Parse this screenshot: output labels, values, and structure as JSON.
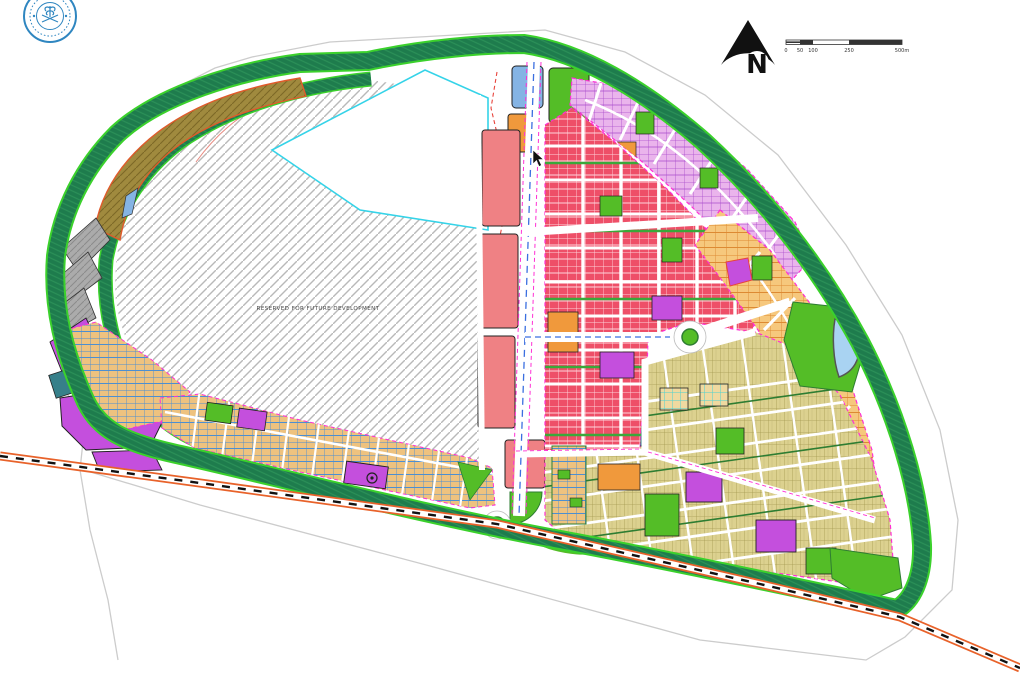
{
  "annotations": {
    "reserved_label": "RESERVED FOR FUTURE DEVELOPMENT"
  },
  "compass": {
    "label": "N"
  },
  "scale_bar": {
    "ticks": [
      "0",
      "50",
      "100",
      "250",
      "500m"
    ]
  },
  "palette": {
    "green_belt": "#1e7c4d",
    "green_belt_edge": "#3bd12c",
    "park_green": "#54bd27",
    "residential_red": "#ee4f68",
    "residential_pink": "#eab4ec",
    "residential_orange_lots": "#f6c87d",
    "residential_khaki": "#dcd18f",
    "lots_blue_hatch": "#4d8fd1",
    "commercial_salmon": "#ef8184",
    "facility_purple": "#c44fdd",
    "facility_blue": "#85b4e4",
    "facility_orange": "#f0993c",
    "facility_teal": "#37808a",
    "agriculture_olive": "#a08a3e",
    "utility_gray": "#ababab",
    "water_blue": "#a9d3f2",
    "railway_orange": "#e8622a",
    "road_edge_magenta": "#ff2fd4",
    "road_center_blue": "#3b6fe0",
    "notch_outline_cyan": "#35d3e8",
    "boundary_gray": "#cccccc",
    "logo_blue": "#2f86c0"
  }
}
